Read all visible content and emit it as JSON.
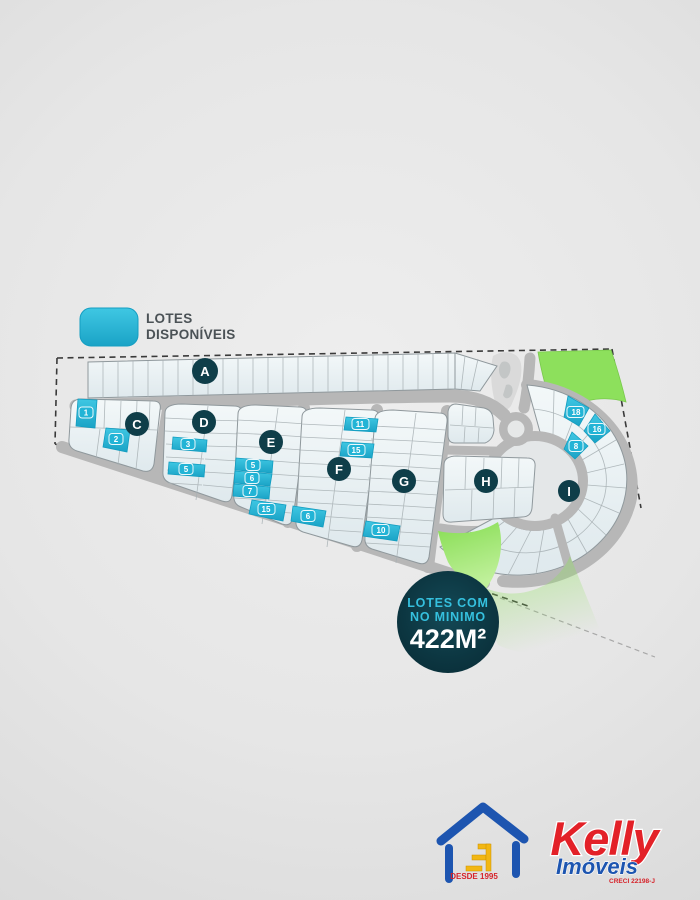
{
  "legend": {
    "line1": "LOTES",
    "line2": "DISPONÍVEIS"
  },
  "sections": {
    "a": "A",
    "c": "C",
    "d": "D",
    "e": "E",
    "f": "F",
    "g": "G",
    "h": "H",
    "i": "I"
  },
  "available_lots": {
    "c": [
      "1",
      "2"
    ],
    "d": [
      "3",
      "5"
    ],
    "e": [
      "5",
      "6",
      "7",
      "15"
    ],
    "f": [
      "11",
      "15",
      "6"
    ],
    "g": [
      "10"
    ],
    "i": [
      "18",
      "16",
      "8"
    ]
  },
  "min_area_badge": {
    "line1": "LOTES COM",
    "line2": "NO MINIMO",
    "value": "422M²"
  },
  "logo": {
    "brand": "Kelly",
    "category": "Imóveis",
    "since": "DESDE 1995",
    "license": "CRECI 22198-J"
  },
  "colors": {
    "available_lot": "#2bb9da",
    "section_label_bg": "#0f3e49",
    "road": "#b7b7b7",
    "green_area": "#8de05c",
    "badge_bg": "#0c3641",
    "badge_accent": "#35c0de",
    "brand_red": "#e32128",
    "brand_blue": "#1d55b0",
    "brand_yellow": "#f2b713"
  }
}
